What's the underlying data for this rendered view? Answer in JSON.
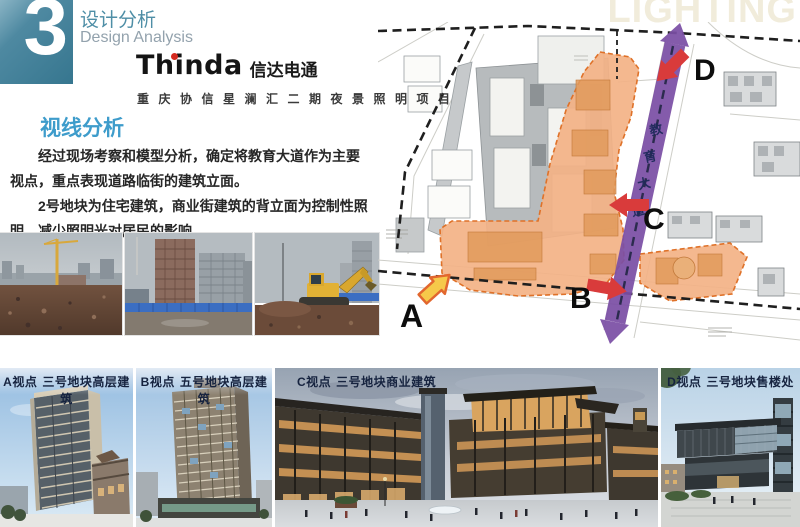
{
  "slide": {
    "section_number": "3",
    "title_zh": "设计分析",
    "title_en": "Design Analysis",
    "watermark": "LIGHTING"
  },
  "brand": {
    "logo_latin": "Thinda",
    "logo_cn": "信达电通",
    "project_line": "重庆协信星澜汇二期夜景照明项目"
  },
  "analysis": {
    "heading": "视线分析",
    "para1": "经过现场考察和模型分析，确定将教育大道作为主要视点，重点表现道路临街的建筑立面。",
    "para2": "2号地块为住宅建筑，商业街建筑的背立面为控制性照明，减少照明光对居民的影响。"
  },
  "site_plan": {
    "road_chars": [
      "教",
      "育",
      "大",
      "道"
    ],
    "markers": {
      "a": "A",
      "b": "B",
      "c": "C",
      "d": "D"
    }
  },
  "viewpoints": [
    {
      "point": "A视点",
      "desc": "三号地块高层建筑"
    },
    {
      "point": "B视点",
      "desc": "五号地块高层建筑"
    },
    {
      "point": "C视点",
      "desc": "三号地块商业建筑"
    },
    {
      "point": "D视点",
      "desc": "三号地块售楼处"
    }
  ],
  "colors": {
    "accent_teal": "#3A7C97",
    "heading_blue": "#3E9CCB",
    "parcel_orange": "#F3B285",
    "road_purple": "#7B4FA5",
    "arrow_red": "#D93B3B",
    "arrow_yellow": "#F6C94A"
  }
}
